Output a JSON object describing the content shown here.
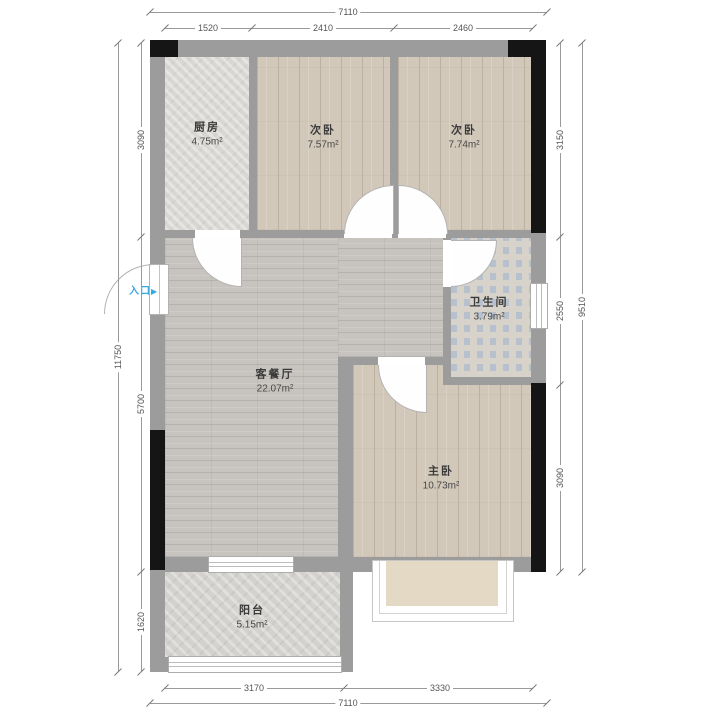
{
  "plan": {
    "entrance": {
      "label": "入口",
      "arrow": "▶"
    },
    "rooms": [
      {
        "id": "kitchen",
        "name": "厨房",
        "area": "4.75m²"
      },
      {
        "id": "bedroom-2",
        "name": "次卧",
        "area": "7.57m²"
      },
      {
        "id": "bedroom-3",
        "name": "次卧",
        "area": "7.74m²"
      },
      {
        "id": "bathroom",
        "name": "卫生间",
        "area": "3.79m²"
      },
      {
        "id": "living-dining",
        "name": "客餐厅",
        "area": "22.07m²"
      },
      {
        "id": "master-bedroom",
        "name": "主卧",
        "area": "10.73m²"
      },
      {
        "id": "balcony",
        "name": "阳台",
        "area": "5.15m²"
      }
    ],
    "dimensions": {
      "top": {
        "total": "7110",
        "segments": [
          "1520",
          "2410",
          "2460"
        ]
      },
      "bottom": {
        "total": "7110",
        "segments": [
          "3170",
          "3330"
        ]
      },
      "left": {
        "total": "11750",
        "segments": [
          "3090",
          "5700",
          "1620"
        ]
      },
      "right": {
        "total": "9510",
        "segments": [
          "3150",
          "2550",
          "3090"
        ]
      }
    },
    "colors": {
      "wall": "#9c9c9c",
      "column": "#151515",
      "entrance_accent": "#36a9e1",
      "wood_floor": "#d2c8ba",
      "bath_tile": "#b7c1cd"
    }
  }
}
